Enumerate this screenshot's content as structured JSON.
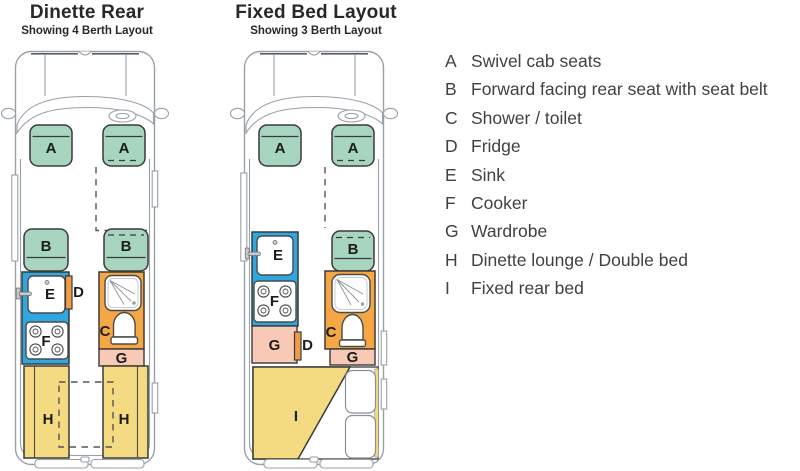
{
  "page": {
    "background": "#ffffff"
  },
  "colors": {
    "seat_green": "#a7d5bf",
    "kitchen_blue": "#2fa7e0",
    "shower_orange": "#f5a744",
    "fridge_orange": "#ee9d45",
    "wardrobe_pink": "#f8cab5",
    "bed_yellow": "#f4da80"
  },
  "layout_left": {
    "title": "Dinette Rear",
    "subtitle": "Showing 4 Berth Layout",
    "labels": {
      "cab_seat_left": "A",
      "cab_seat_right": "A",
      "rear_seat_left": "B",
      "rear_seat_right": "B",
      "sink": "E",
      "fridge": "D",
      "cooker": "F",
      "shower_toilet": "C",
      "wardrobe": "G",
      "bench_left": "H",
      "bench_right": "H"
    }
  },
  "layout_right": {
    "title": "Fixed Bed Layout",
    "subtitle": "Showing 3 Berth Layout",
    "labels": {
      "cab_seat_left": "A",
      "cab_seat_right": "A",
      "rear_seat": "B",
      "sink": "E",
      "cooker": "F",
      "wardrobe_left": "G",
      "fridge": "D",
      "shower_toilet": "C",
      "wardrobe_right": "G",
      "fixed_bed": "I"
    }
  },
  "legend": {
    "items": [
      {
        "key": "A",
        "text": "Swivel cab seats"
      },
      {
        "key": "B",
        "text": "Forward facing rear seat with seat belt"
      },
      {
        "key": "C",
        "text": "Shower / toilet"
      },
      {
        "key": "D",
        "text": "Fridge"
      },
      {
        "key": "E",
        "text": "Sink"
      },
      {
        "key": "F",
        "text": "Cooker"
      },
      {
        "key": "G",
        "text": "Wardrobe"
      },
      {
        "key": "H",
        "text": "Dinette lounge / Double bed"
      },
      {
        "key": "I",
        "text": "Fixed rear bed"
      }
    ]
  }
}
